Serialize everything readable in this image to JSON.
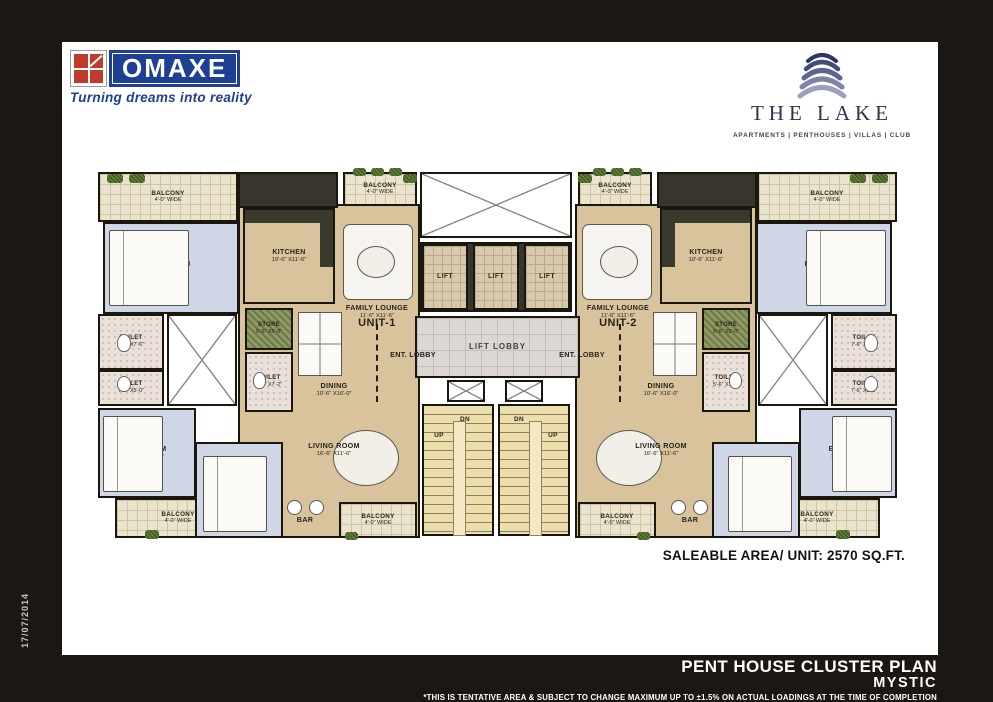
{
  "frame": {
    "date_stamp": "17/07/2014"
  },
  "header": {
    "omaxe": {
      "name": "OMAXE",
      "tagline": "Turning dreams into reality"
    },
    "lake": {
      "name": "THE LAKE",
      "categories": "APARTMENTS | PENTHOUSES | VILLAS | CLUB"
    }
  },
  "plan": {
    "saleable_area": "SALEABLE AREA/ UNIT: 2570 SQ.FT.",
    "rooms": [
      {
        "id": "unit1-open-area",
        "type": "open",
        "x": 143,
        "y": 36,
        "w": 182,
        "h": 334
      },
      {
        "id": "unit2-open-area",
        "type": "open",
        "x": 480,
        "y": 36,
        "w": 182,
        "h": 334
      },
      {
        "id": "unit1-kitchen-top-wall",
        "type": "counter",
        "x": 143,
        "y": 4,
        "w": 100,
        "h": 36
      },
      {
        "id": "unit2-kitchen-top-wall",
        "type": "counter",
        "x": 562,
        "y": 4,
        "w": 100,
        "h": 36
      },
      {
        "id": "lift-bank-wall",
        "type": "counter",
        "x": 325,
        "y": 74,
        "w": 152,
        "h": 70
      },
      {
        "id": "unit1-balcony-top-left",
        "type": "balcony",
        "label": "BALCONY",
        "dims": "4'-0\" WIDE",
        "x": 3,
        "y": 4,
        "w": 140,
        "h": 50
      },
      {
        "id": "unit1-balcony-top-center",
        "type": "balcony",
        "label": "BALCONY",
        "dims": "4'-0\" WIDE",
        "x": 248,
        "y": 4,
        "w": 74,
        "h": 34
      },
      {
        "id": "unit1-bedroom-1",
        "type": "bedroom",
        "label": "BEDROOM",
        "dims": "10'-6\" X11'-4\"",
        "x": 8,
        "y": 54,
        "w": 136,
        "h": 92
      },
      {
        "id": "unit1-kitchen",
        "type": "kitchen",
        "label": "KITCHEN",
        "dims": "10'-6\" X11'-6\"",
        "x": 148,
        "y": 40,
        "w": 92,
        "h": 96
      },
      {
        "id": "unit1-toilet-1",
        "type": "toilet",
        "label": "TOILET",
        "dims": "7'-6\" X7'-6\"",
        "x": 3,
        "y": 146,
        "w": 66,
        "h": 56
      },
      {
        "id": "unit1-toilet-2",
        "type": "toilet",
        "label": "TOILET",
        "dims": "7'-6\" X5'-0\"",
        "x": 3,
        "y": 202,
        "w": 66,
        "h": 36
      },
      {
        "id": "unit1-shaft",
        "type": "shaft",
        "x": 72,
        "y": 146,
        "w": 70,
        "h": 92
      },
      {
        "id": "unit1-store",
        "type": "store",
        "label": "STORE",
        "dims": "5'-6\" X5'-0\"",
        "x": 150,
        "y": 140,
        "w": 48,
        "h": 42
      },
      {
        "id": "unit1-toilet-3",
        "type": "toilet",
        "label": "TOILET",
        "dims": "5'-6\" X7'-2\"",
        "x": 150,
        "y": 184,
        "w": 48,
        "h": 60
      },
      {
        "id": "unit1-bedroom-2",
        "type": "bedroom",
        "label": "BEDROOM",
        "dims": "11'-0\" X13'-2\"",
        "x": 3,
        "y": 240,
        "w": 98,
        "h": 90
      },
      {
        "id": "unit1-balcony-bottom-left",
        "type": "balcony",
        "label": "BALCONY",
        "dims": "4'-0\" WIDE",
        "x": 20,
        "y": 330,
        "w": 126,
        "h": 40
      },
      {
        "id": "unit1-bedroom-3",
        "type": "bedroom",
        "label": "BEDROOM",
        "dims": "12'-1\" X11'-6\"",
        "x": 100,
        "y": 274,
        "w": 88,
        "h": 96
      },
      {
        "id": "unit1-balcony-bottom-center",
        "type": "balcony",
        "label": "BALCONY",
        "dims": "4'-0\" WIDE",
        "x": 244,
        "y": 334,
        "w": 78,
        "h": 36
      },
      {
        "id": "core-open-shaft",
        "type": "shaft",
        "x": 325,
        "y": 4,
        "w": 152,
        "h": 66
      },
      {
        "id": "lift-1",
        "type": "lift",
        "label": "LIFT",
        "x": 327,
        "y": 76,
        "w": 46,
        "h": 66
      },
      {
        "id": "lift-2",
        "type": "lift",
        "label": "LIFT",
        "x": 378,
        "y": 76,
        "w": 46,
        "h": 66
      },
      {
        "id": "lift-3",
        "type": "lift",
        "label": "LIFT",
        "x": 429,
        "y": 76,
        "w": 46,
        "h": 66
      },
      {
        "id": "lift-lobby",
        "type": "lobby",
        "label": "LIFT LOBBY",
        "x": 320,
        "y": 148,
        "w": 165,
        "h": 62
      },
      {
        "id": "stair-shaft-1",
        "type": "shaft",
        "x": 352,
        "y": 212,
        "w": 38,
        "h": 22
      },
      {
        "id": "stair-shaft-2",
        "type": "shaft",
        "x": 410,
        "y": 212,
        "w": 38,
        "h": 22
      },
      {
        "id": "staircase-1",
        "type": "stairs",
        "x": 327,
        "y": 236,
        "w": 72,
        "h": 132
      },
      {
        "id": "staircase-2",
        "type": "stairs",
        "x": 403,
        "y": 236,
        "w": 72,
        "h": 132
      },
      {
        "id": "unit2-balcony-top-right",
        "type": "balcony",
        "label": "BALCONY",
        "dims": "4'-0\" WIDE",
        "x": 662,
        "y": 4,
        "w": 140,
        "h": 50
      },
      {
        "id": "unit2-balcony-top-center",
        "type": "balcony",
        "label": "BALCONY",
        "dims": "4'-0\" WIDE",
        "x": 483,
        "y": 4,
        "w": 74,
        "h": 34
      },
      {
        "id": "unit2-bedroom-1",
        "type": "bedroom",
        "label": "BEDROOM",
        "dims": "10'-6\" X11'-4\"",
        "x": 661,
        "y": 54,
        "w": 136,
        "h": 92
      },
      {
        "id": "unit2-kitchen",
        "type": "kitchen",
        "flip": true,
        "label": "KITCHEN",
        "dims": "10'-6\" X11'-6\"",
        "x": 565,
        "y": 40,
        "w": 92,
        "h": 96
      },
      {
        "id": "unit2-toilet-1",
        "type": "toilet",
        "label": "TOILET",
        "dims": "7'-6\" X7'-6\"",
        "x": 736,
        "y": 146,
        "w": 66,
        "h": 56
      },
      {
        "id": "unit2-toilet-2",
        "type": "toilet",
        "label": "TOILET",
        "dims": "7'-6\" X5'-0\"",
        "x": 736,
        "y": 202,
        "w": 66,
        "h": 36
      },
      {
        "id": "unit2-shaft",
        "type": "shaft",
        "x": 663,
        "y": 146,
        "w": 70,
        "h": 92
      },
      {
        "id": "unit2-store",
        "type": "store",
        "label": "STORE",
        "dims": "5'-6\" X5'-0\"",
        "x": 607,
        "y": 140,
        "w": 48,
        "h": 42
      },
      {
        "id": "unit2-toilet-3",
        "type": "toilet",
        "label": "TOILET",
        "dims": "5'-6\" X7'-2\"",
        "x": 607,
        "y": 184,
        "w": 48,
        "h": 60
      },
      {
        "id": "unit2-bedroom-2",
        "type": "bedroom",
        "label": "BEDROOM",
        "dims": "11'-0\" X13'-2\"",
        "x": 704,
        "y": 240,
        "w": 98,
        "h": 90
      },
      {
        "id": "unit2-balcony-bottom-right",
        "type": "balcony",
        "label": "BALCONY",
        "dims": "4'-0\" WIDE",
        "x": 659,
        "y": 330,
        "w": 126,
        "h": 40
      },
      {
        "id": "unit2-bedroom-3",
        "type": "bedroom",
        "label": "BEDROOM",
        "dims": "12'-1\" X11'-6\"",
        "x": 617,
        "y": 274,
        "w": 88,
        "h": 96
      },
      {
        "id": "unit2-balcony-bottom-center",
        "type": "balcony",
        "label": "BALCONY",
        "dims": "4'-0\" WIDE",
        "x": 483,
        "y": 334,
        "w": 78,
        "h": 36
      },
      {
        "id": "unit1-family-lounge-label",
        "type": "label",
        "label": "FAMILY LOUNGE",
        "dims": "11'-6\" X11'-6\"",
        "x": 240,
        "y": 134,
        "w": 84,
        "h": 20
      },
      {
        "id": "unit1-label",
        "type": "ulabel",
        "label": "UNIT-1",
        "x": 250,
        "y": 146,
        "w": 64,
        "h": 18
      },
      {
        "id": "unit1-ent-lobby-label",
        "type": "label",
        "label": "ENT. LOBBY",
        "x": 288,
        "y": 180,
        "w": 60,
        "h": 14
      },
      {
        "id": "unit1-ent-lobby-dash",
        "type": "dashv",
        "x": 281,
        "y": 156,
        "w": 0,
        "h": 78
      },
      {
        "id": "unit1-dining-label",
        "type": "label",
        "label": "DINING",
        "dims": "10'-6\" X16'-0\"",
        "x": 196,
        "y": 212,
        "w": 86,
        "h": 20
      },
      {
        "id": "unit1-living-room-label",
        "type": "label",
        "label": "LIVING ROOM",
        "dims": "16'-6\" X11'-6\"",
        "x": 196,
        "y": 272,
        "w": 86,
        "h": 20
      },
      {
        "id": "unit1-bar-label",
        "type": "label",
        "label": "BAR",
        "x": 190,
        "y": 346,
        "w": 40,
        "h": 12
      },
      {
        "id": "unit2-family-lounge-label",
        "type": "label",
        "label": "FAMILY LOUNGE",
        "dims": "11'-6\" X11'-6\"",
        "x": 481,
        "y": 134,
        "w": 84,
        "h": 20
      },
      {
        "id": "unit2-label",
        "type": "ulabel",
        "label": "UNIT-2",
        "x": 491,
        "y": 146,
        "w": 64,
        "h": 18
      },
      {
        "id": "unit2-ent-lobby-label",
        "type": "label",
        "label": "ENT. LOBBY",
        "x": 457,
        "y": 180,
        "w": 60,
        "h": 14
      },
      {
        "id": "unit2-ent-lobby-dash",
        "type": "dashv",
        "x": 524,
        "y": 156,
        "w": 0,
        "h": 78
      },
      {
        "id": "unit2-dining-label",
        "type": "label",
        "label": "DINING",
        "dims": "10'-6\" X16'-0\"",
        "x": 523,
        "y": 212,
        "w": 86,
        "h": 20
      },
      {
        "id": "unit2-living-room-label",
        "type": "label",
        "label": "LIVING ROOM",
        "dims": "16'-6\" X11'-6\"",
        "x": 523,
        "y": 272,
        "w": 86,
        "h": 20
      },
      {
        "id": "unit2-bar-label",
        "type": "label",
        "label": "BAR",
        "x": 575,
        "y": 346,
        "w": 40,
        "h": 12
      },
      {
        "id": "staircase-1-dn-label",
        "type": "slabel",
        "label": "DN",
        "x": 358,
        "y": 246,
        "w": 24,
        "h": 12
      },
      {
        "id": "staircase-1-up-label",
        "type": "slabel",
        "label": "UP",
        "x": 332,
        "y": 262,
        "w": 24,
        "h": 12
      },
      {
        "id": "staircase-2-dn-label",
        "type": "slabel",
        "label": "DN",
        "x": 412,
        "y": 246,
        "w": 24,
        "h": 12
      },
      {
        "id": "staircase-2-up-label",
        "type": "slabel",
        "label": "UP",
        "x": 446,
        "y": 262,
        "w": 24,
        "h": 12
      }
    ],
    "furniture": [
      {
        "t": "bed",
        "x": 14,
        "y": 62,
        "w": 80,
        "h": 76
      },
      {
        "t": "bed",
        "x": 8,
        "y": 248,
        "w": 60,
        "h": 76
      },
      {
        "t": "bed",
        "x": 108,
        "y": 288,
        "w": 64,
        "h": 76
      },
      {
        "t": "bed",
        "x": 711,
        "y": 62,
        "w": 80,
        "h": 76
      },
      {
        "t": "bed",
        "x": 737,
        "y": 248,
        "w": 60,
        "h": 76
      },
      {
        "t": "bed",
        "x": 633,
        "y": 288,
        "w": 64,
        "h": 76
      },
      {
        "t": "sofa",
        "x": 248,
        "y": 56,
        "w": 70,
        "h": 76
      },
      {
        "t": "sofa",
        "x": 487,
        "y": 56,
        "w": 70,
        "h": 76
      },
      {
        "t": "oval",
        "x": 262,
        "y": 78,
        "w": 38,
        "h": 32
      },
      {
        "t": "oval",
        "x": 505,
        "y": 78,
        "w": 38,
        "h": 32
      },
      {
        "t": "table",
        "x": 203,
        "y": 144,
        "w": 44,
        "h": 64
      },
      {
        "t": "table",
        "x": 558,
        "y": 144,
        "w": 44,
        "h": 64
      },
      {
        "t": "oval",
        "x": 238,
        "y": 262,
        "w": 66,
        "h": 56
      },
      {
        "t": "oval",
        "x": 501,
        "y": 262,
        "w": 66,
        "h": 56
      },
      {
        "t": "stool",
        "x": 192,
        "y": 332,
        "w": 15,
        "h": 15
      },
      {
        "t": "stool",
        "x": 214,
        "y": 332,
        "w": 15,
        "h": 15
      },
      {
        "t": "stool",
        "x": 598,
        "y": 332,
        "w": 15,
        "h": 15
      },
      {
        "t": "stool",
        "x": 576,
        "y": 332,
        "w": 15,
        "h": 15
      },
      {
        "t": "wc",
        "x": 22,
        "y": 166,
        "w": 14,
        "h": 18
      },
      {
        "t": "wc",
        "x": 22,
        "y": 208,
        "w": 14,
        "h": 16
      },
      {
        "t": "wc",
        "x": 158,
        "y": 204,
        "w": 13,
        "h": 17
      },
      {
        "t": "wc",
        "x": 769,
        "y": 166,
        "w": 14,
        "h": 18
      },
      {
        "t": "wc",
        "x": 769,
        "y": 208,
        "w": 14,
        "h": 16
      },
      {
        "t": "wc",
        "x": 634,
        "y": 204,
        "w": 13,
        "h": 17
      },
      {
        "t": "plant",
        "x": 12,
        "y": 6,
        "w": 16,
        "h": 9
      },
      {
        "t": "plant",
        "x": 34,
        "y": 6,
        "w": 16,
        "h": 9
      },
      {
        "t": "plant",
        "x": 258,
        "y": 0,
        "w": 13,
        "h": 8
      },
      {
        "t": "plant",
        "x": 276,
        "y": 0,
        "w": 13,
        "h": 8
      },
      {
        "t": "plant",
        "x": 294,
        "y": 0,
        "w": 13,
        "h": 8
      },
      {
        "t": "plant",
        "x": 308,
        "y": 6,
        "w": 14,
        "h": 9
      },
      {
        "t": "plant",
        "x": 50,
        "y": 362,
        "w": 14,
        "h": 9
      },
      {
        "t": "plant",
        "x": 250,
        "y": 364,
        "w": 13,
        "h": 8
      },
      {
        "t": "plant",
        "x": 777,
        "y": 6,
        "w": 16,
        "h": 9
      },
      {
        "t": "plant",
        "x": 755,
        "y": 6,
        "w": 16,
        "h": 9
      },
      {
        "t": "plant",
        "x": 534,
        "y": 0,
        "w": 13,
        "h": 8
      },
      {
        "t": "plant",
        "x": 516,
        "y": 0,
        "w": 13,
        "h": 8
      },
      {
        "t": "plant",
        "x": 498,
        "y": 0,
        "w": 13,
        "h": 8
      },
      {
        "t": "plant",
        "x": 483,
        "y": 6,
        "w": 14,
        "h": 9
      },
      {
        "t": "plant",
        "x": 741,
        "y": 362,
        "w": 14,
        "h": 9
      },
      {
        "t": "plant",
        "x": 542,
        "y": 364,
        "w": 13,
        "h": 8
      }
    ]
  },
  "footer": {
    "title": "PENT HOUSE CLUSTER PLAN",
    "subtitle": "MYSTIC",
    "disclaimer": "*THIS IS TENTATIVE AREA & SUBJECT TO CHANGE MAXIMUM UP TO ±1.5% ON ACTUAL  LOADINGS AT THE TIME OF COMPLETION"
  },
  "colors": {
    "frame_black": "#1b1814",
    "omaxe_blue": "#1d3f94",
    "omaxe_red": "#c03a2b",
    "lake_navy": "#2e3250",
    "open_floor_beige": "#d9c39c",
    "bedroom_blue": "#cfd7e6",
    "stairs_tan": "#eddfab",
    "store_green": "#8f9a63"
  }
}
